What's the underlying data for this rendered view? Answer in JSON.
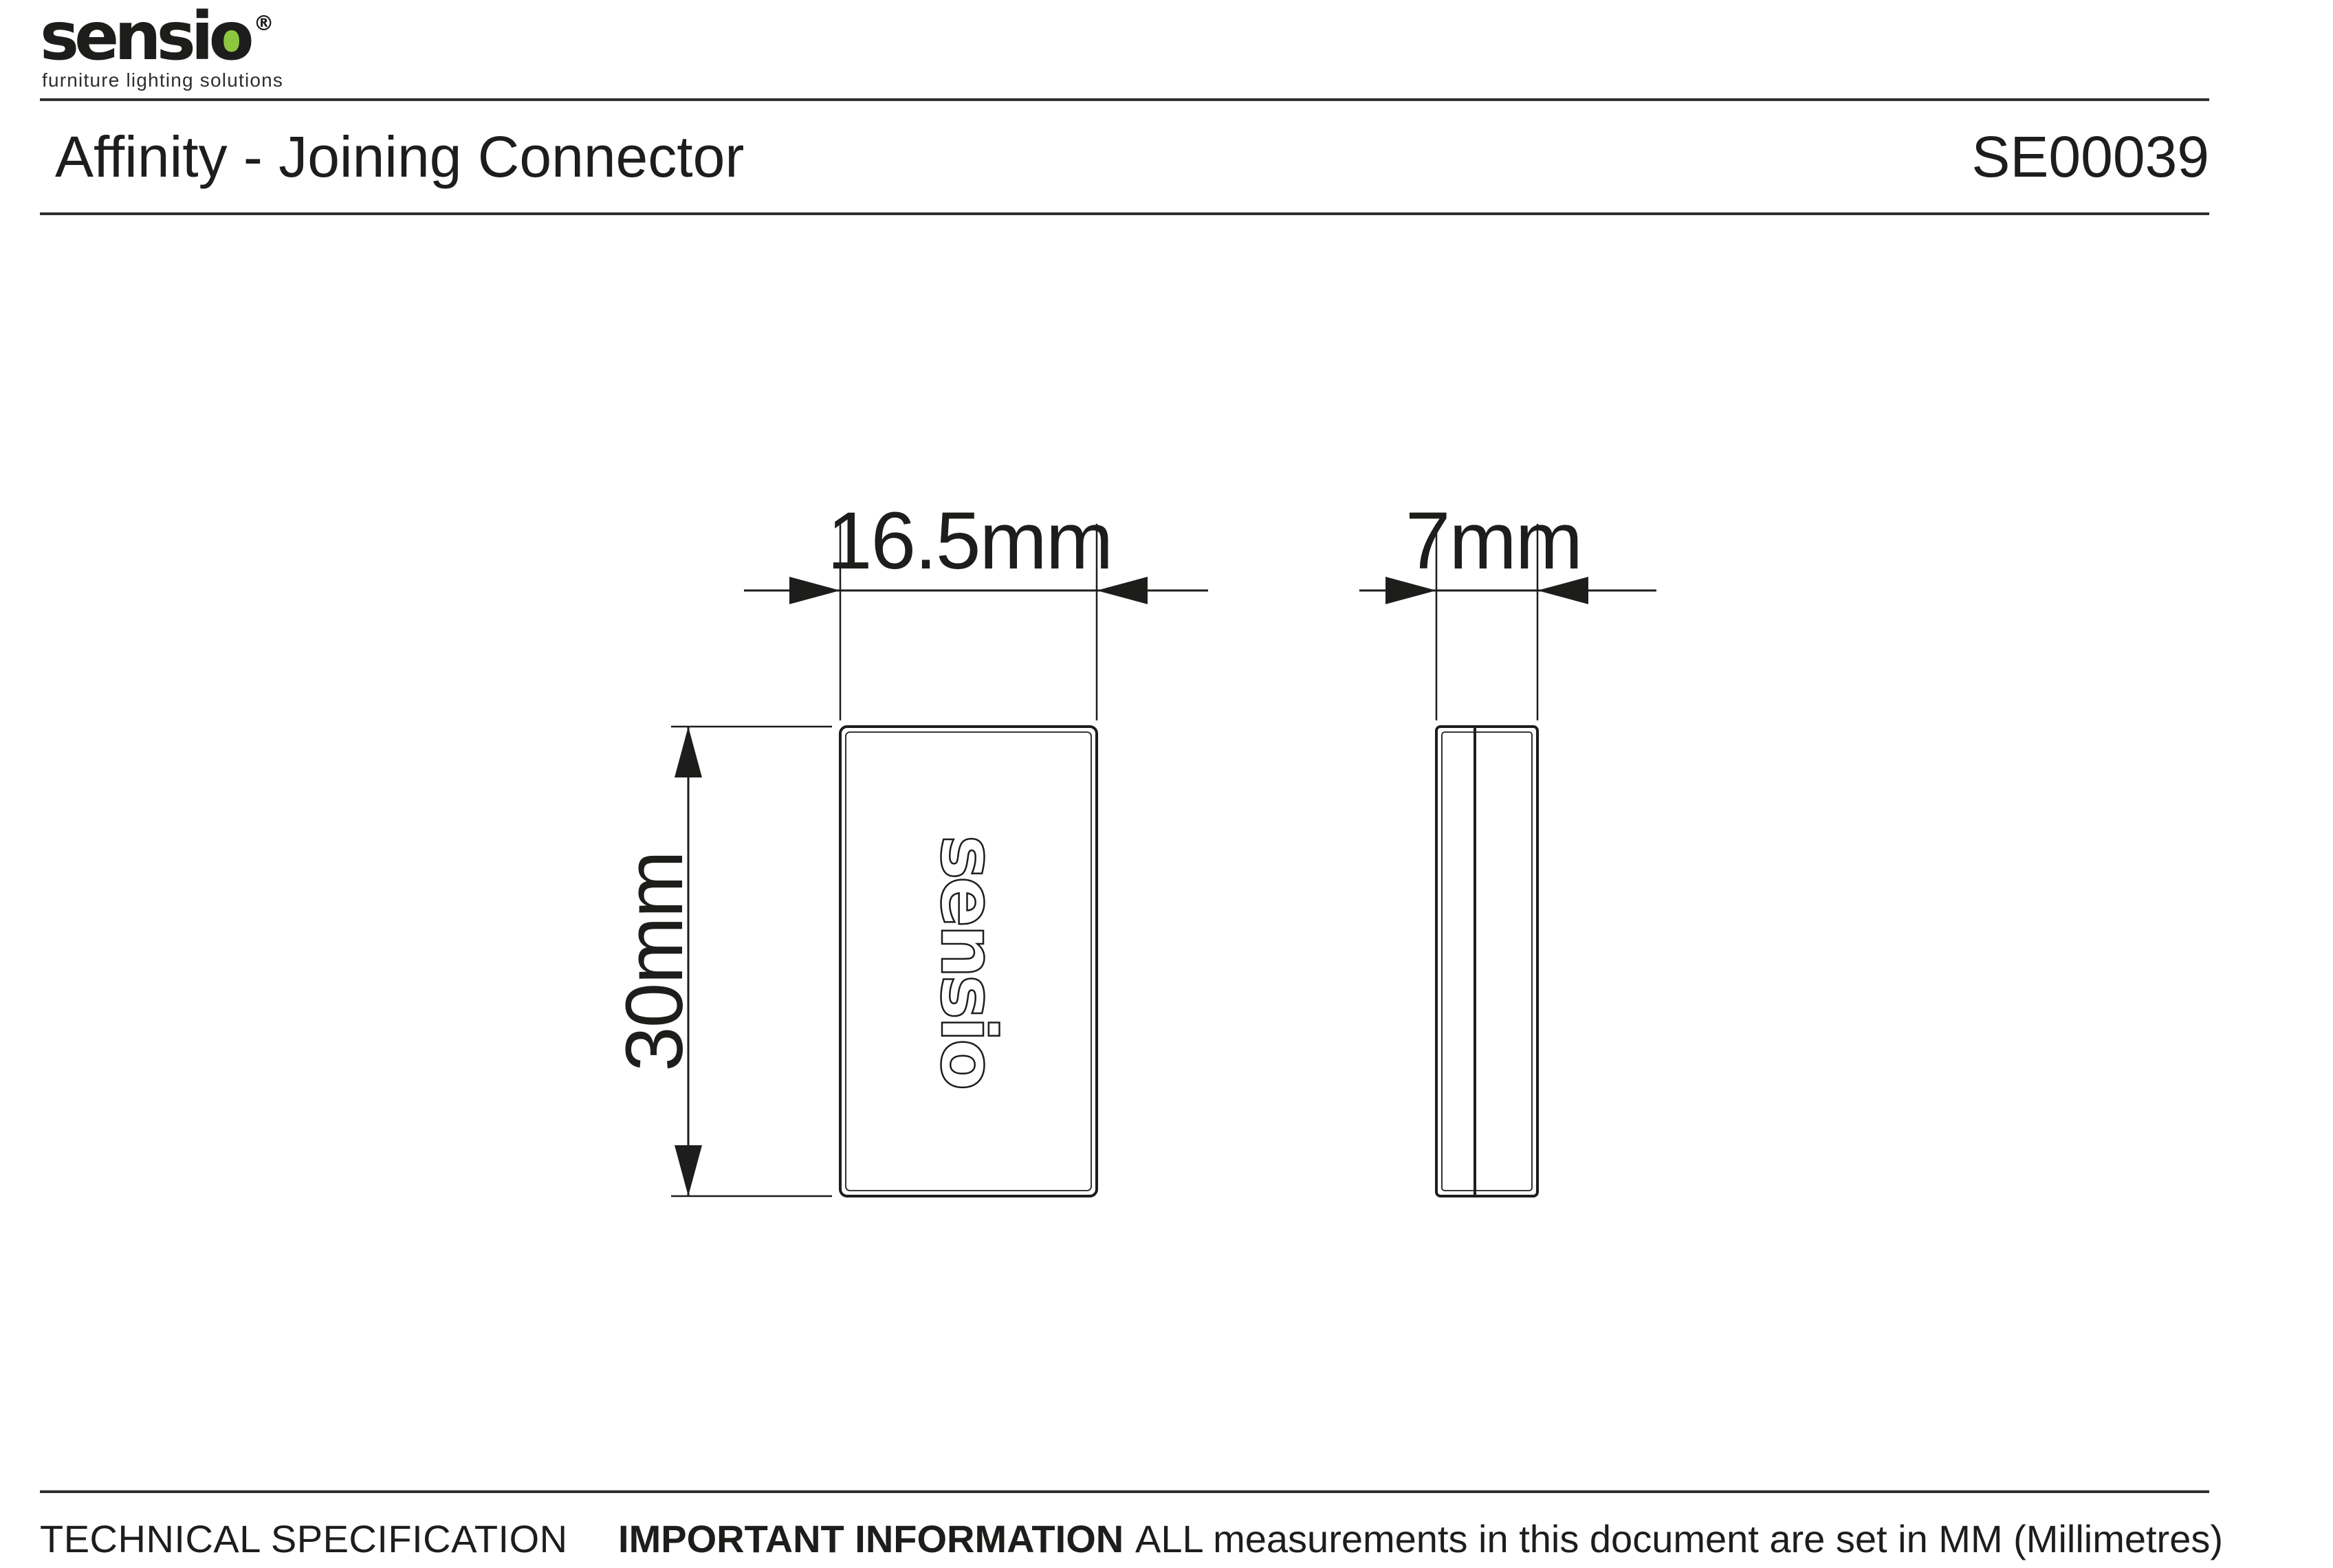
{
  "page": {
    "background": "#ffffff",
    "ink_color": "#1d1d1b",
    "accent_green": "#8dc63f"
  },
  "header": {
    "logo": {
      "wordmark_prefix": "sensi",
      "wordmark_o": "o",
      "registered_mark": "®",
      "tagline": "furniture lighting solutions"
    },
    "title": "Affinity - Joining Connector",
    "product_code": "SE00039"
  },
  "drawing": {
    "front_view": {
      "width_label": "16.5mm",
      "height_label": "30mm",
      "embossed_logo_text": "sensio"
    },
    "side_view": {
      "depth_label": "7mm"
    }
  },
  "footer": {
    "left_label": "TECHNICAL SPECIFICATION",
    "right_label_bold": "IMPORTANT INFORMATION",
    "right_label_text": "ALL measurements in this document are set in MM (Millimetres)"
  }
}
